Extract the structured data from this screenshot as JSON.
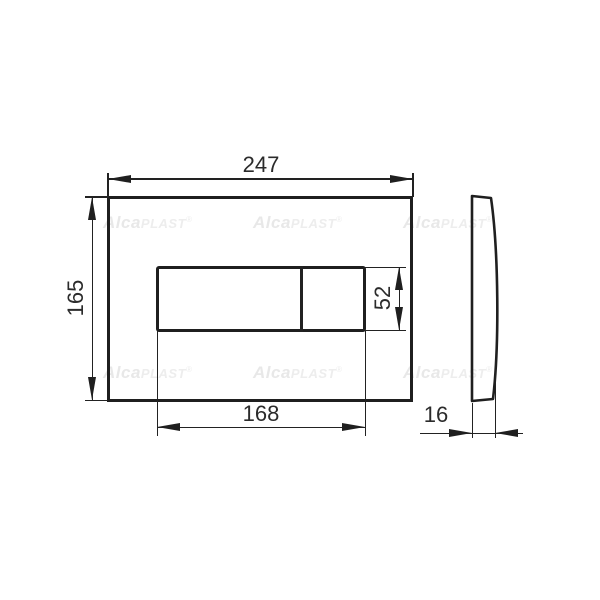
{
  "drawing": {
    "dimensions": {
      "plate_width": "247",
      "plate_height": "165",
      "buttons_width": "168",
      "button_height": "52",
      "plate_depth": "16"
    },
    "watermark": {
      "brand_bold": "Alca",
      "brand_light": "PLAST",
      "registered": "®"
    },
    "colors": {
      "line": "#1f1f1f",
      "dim_text": "#2b2b2b",
      "watermark": "#e8e8e8",
      "background": "#ffffff"
    }
  }
}
